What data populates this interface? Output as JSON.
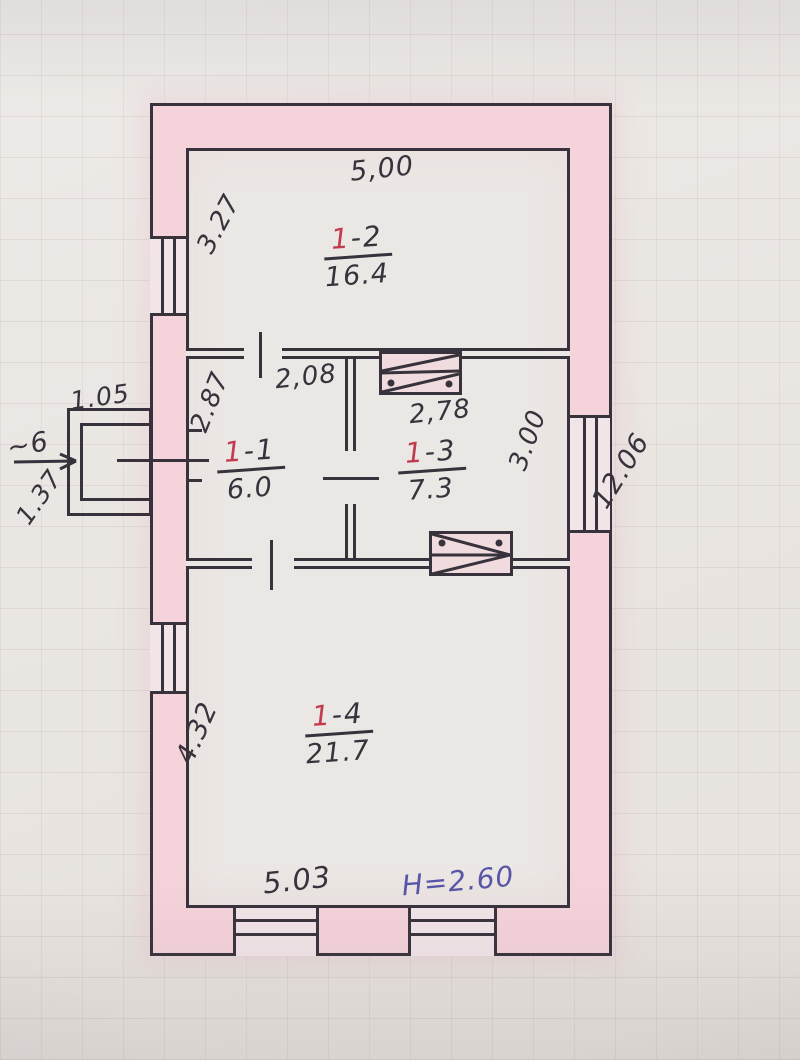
{
  "plan": {
    "title": "hand-drawn apartment floor plan (BTI sketch)",
    "rooms": [
      {
        "id": "1-2",
        "label_red": "1",
        "label_rest": "-2",
        "area": "16.4"
      },
      {
        "id": "1-1",
        "label_red": "1",
        "label_rest": "-1",
        "area": "6.0"
      },
      {
        "id": "1-3",
        "label_red": "1",
        "label_rest": "-3",
        "area": "7.3"
      },
      {
        "id": "1-4",
        "label_red": "1",
        "label_rest": "-4",
        "area": "21.7"
      }
    ],
    "dimensions": {
      "top_width": "5,00",
      "room12_left_height": "3.27",
      "room11_width": "2,08",
      "room11_left_height": "2.87",
      "room13_width": "2,78",
      "room13_right_height": "3.00",
      "right_total_height": "12.06",
      "porch_width": "1.05",
      "porch_height": "1.37",
      "porch_mark": "~6",
      "room14_left_height": "4.32",
      "bottom_width": "5.03",
      "ceiling_height": "H=2.60"
    },
    "colors": {
      "paper": "#e9e5e1",
      "room_bg": "#ebe7e4",
      "wall_fill": "#f5d3db",
      "ink": "#37323c",
      "red_ink": "#c23a4e",
      "blue_ink": "#5856a6"
    }
  }
}
